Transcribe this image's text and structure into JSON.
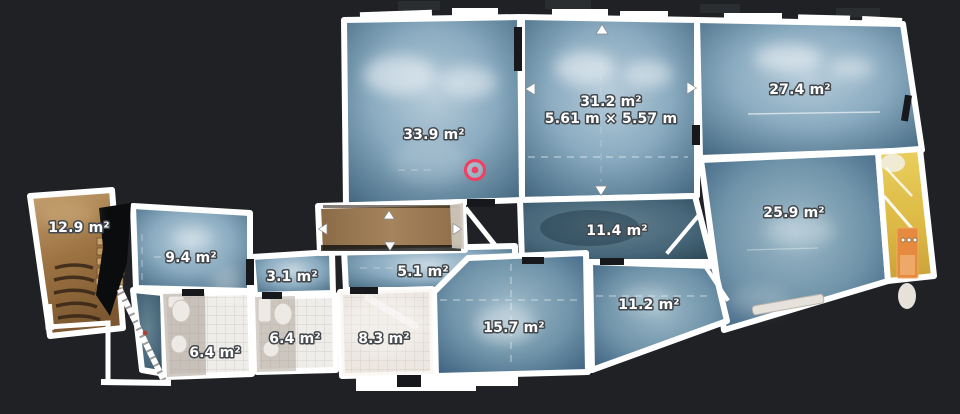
{
  "colors": {
    "background": "#1f2125",
    "wall": "#ffffff",
    "marker_accent": "#ee4163",
    "label_text": "#ffffff",
    "label_outline": "#43484d",
    "stairwell_accent": "#e58a3e"
  },
  "floorplan": {
    "marker": {
      "icon": "scan-position-target-icon",
      "color": "#ee4163"
    },
    "icons": {
      "selected_room_handles": [
        "arrow-up-icon",
        "arrow-left-icon",
        "arrow-right-icon",
        "arrow-down-icon"
      ],
      "balcony_handles": [
        "arrow-up-icon",
        "arrow-left-icon",
        "arrow-right-icon",
        "arrow-down-icon"
      ]
    },
    "rooms": [
      {
        "id": "staircase",
        "area": "12.9 m²"
      },
      {
        "id": "room-9-4",
        "area": "9.4 m²"
      },
      {
        "id": "hall-3-1",
        "area": "3.1 m²"
      },
      {
        "id": "hall-5-1",
        "area": "5.1 m²"
      },
      {
        "id": "bathroom-left",
        "area": "6.4 m²"
      },
      {
        "id": "bathroom-right",
        "area": "6.4 m²"
      },
      {
        "id": "room-8-3",
        "area": "8.3 m²"
      },
      {
        "id": "room-15-7",
        "area": "15.7 m²"
      },
      {
        "id": "room-11-2",
        "area": "11.2 m²"
      },
      {
        "id": "hall-11-4",
        "area": "11.4 m²"
      },
      {
        "id": "room-33-9",
        "area": "33.9 m²"
      },
      {
        "id": "room-31-2",
        "area": "31.2 m²",
        "dimensions": "5.61 m × 5.57 m",
        "selected": true
      },
      {
        "id": "room-27-4",
        "area": "27.4 m²"
      },
      {
        "id": "room-25-9",
        "area": "25.9 m²"
      }
    ]
  }
}
